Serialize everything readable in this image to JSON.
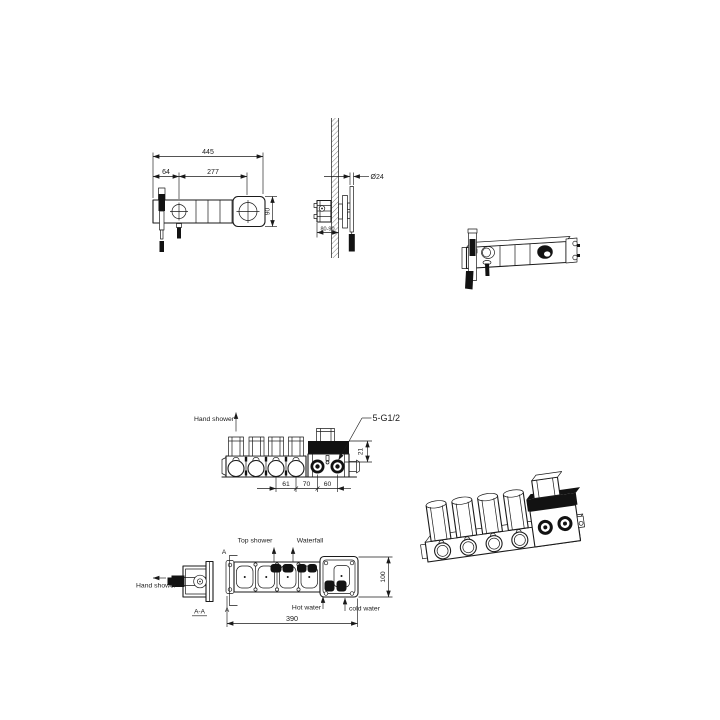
{
  "canvas": {
    "background": "#ffffff",
    "ink": "#1a1a1a"
  },
  "front_view": {
    "dim_total_length": "445",
    "dim_handle_to_dial": "277",
    "dim_end_to_handle": "64",
    "dim_bar_height": "90"
  },
  "side_view": {
    "dim_hand_shower_dia": "Ø24",
    "dim_wall_depth": "80-90"
  },
  "rough_in_front": {
    "hand_shower_label": "Hand shower",
    "thread_callout": "5-G1/2",
    "dim_band": "21",
    "dim_span_a": "61",
    "dim_span_b": "70",
    "dim_span_c": "60"
  },
  "rough_in_top": {
    "top_shower_label": "Top shower",
    "waterfall_label": "Waterfall",
    "hot_water_label": "Hot water",
    "cold_water_label": "cold water",
    "dim_length": "390",
    "dim_width": "100",
    "section_mark": "A"
  },
  "section_aa": {
    "hand_shower_label": "Hand shower",
    "title": "A-A"
  }
}
